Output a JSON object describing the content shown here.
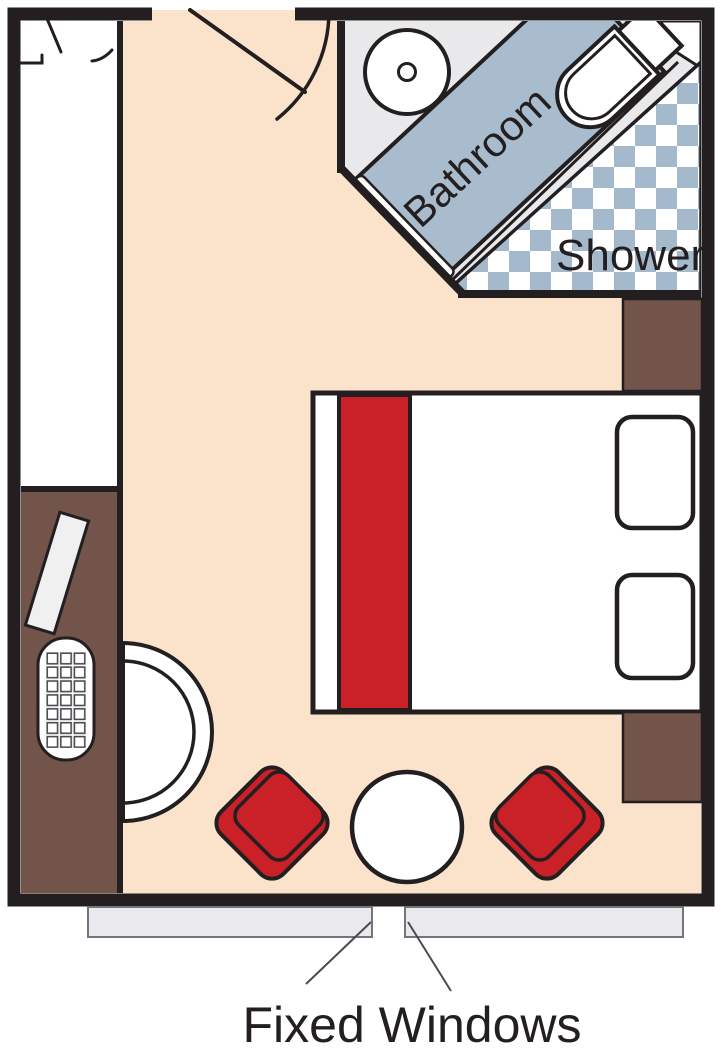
{
  "labels": {
    "bathroom": "Bathroom",
    "shower": "Shower",
    "fixed_windows": "Fixed Windows"
  },
  "colors": {
    "ink": "#231f20",
    "floor": "#fbe3cb",
    "wood": "#72544a",
    "red": "#c92127",
    "band_blue": "#a8bccd",
    "checker_blue": "#a4b9cb",
    "bath_floor": "#e9e9eb",
    "window_gray": "#e9e9ee",
    "white": "#ffffff",
    "soft_line": "#4a4a4f",
    "item_gray": "#f0f0f0"
  },
  "furniture": [
    "entry-door",
    "closet",
    "wardrobe-counter",
    "grooming-item",
    "telephone-keypad",
    "stool",
    "washbasin",
    "toilet",
    "bathroom-counter",
    "bathroom-door",
    "shower-floor",
    "bed",
    "bed-runner",
    "pillow-top",
    "pillow-bottom",
    "nightstand-top",
    "nightstand-bottom",
    "armchair-left",
    "armchair-right",
    "coffee-table",
    "fixed-window-left",
    "fixed-window-right"
  ]
}
